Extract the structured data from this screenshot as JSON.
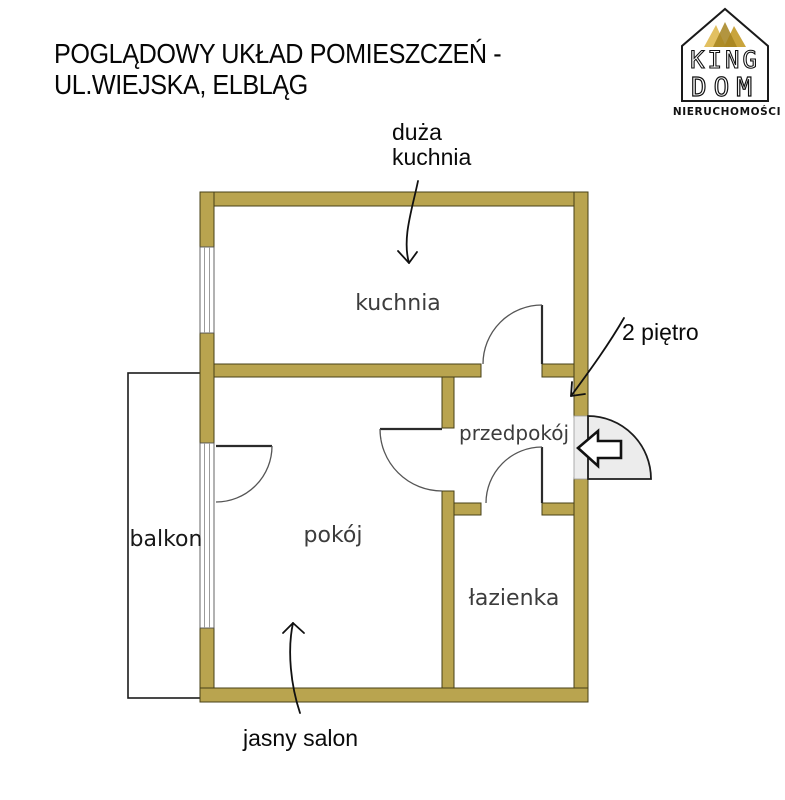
{
  "title": {
    "line1": "POGLĄDOWY UKŁAD POMIESZCZEŃ -",
    "line2": "UL.WIEJSKA, ELBLĄG"
  },
  "logo": {
    "name_top": "KING",
    "name_bottom": "DOM",
    "subtitle": "NIERUCHOMOŚCI"
  },
  "rooms": {
    "kitchen": "kuchnia",
    "hallway": "przedpokój",
    "living_room": "pokój",
    "bathroom": "łazienka",
    "balcony": "balkon"
  },
  "annotations": {
    "kitchen_note_line1": "duża",
    "kitchen_note_line2": "kuchnia",
    "floor_note": "2 piętro",
    "salon_note": "jasny salon"
  },
  "colors": {
    "wall": "#b9a44f",
    "wall_outline": "#2b2713",
    "door_fill": "#ececec",
    "room_label": "#3c3c3c",
    "ink": "#111111",
    "gold_light": "#e2c061",
    "gold_mid": "#c9a43c",
    "gold_dark": "#a5821f"
  }
}
